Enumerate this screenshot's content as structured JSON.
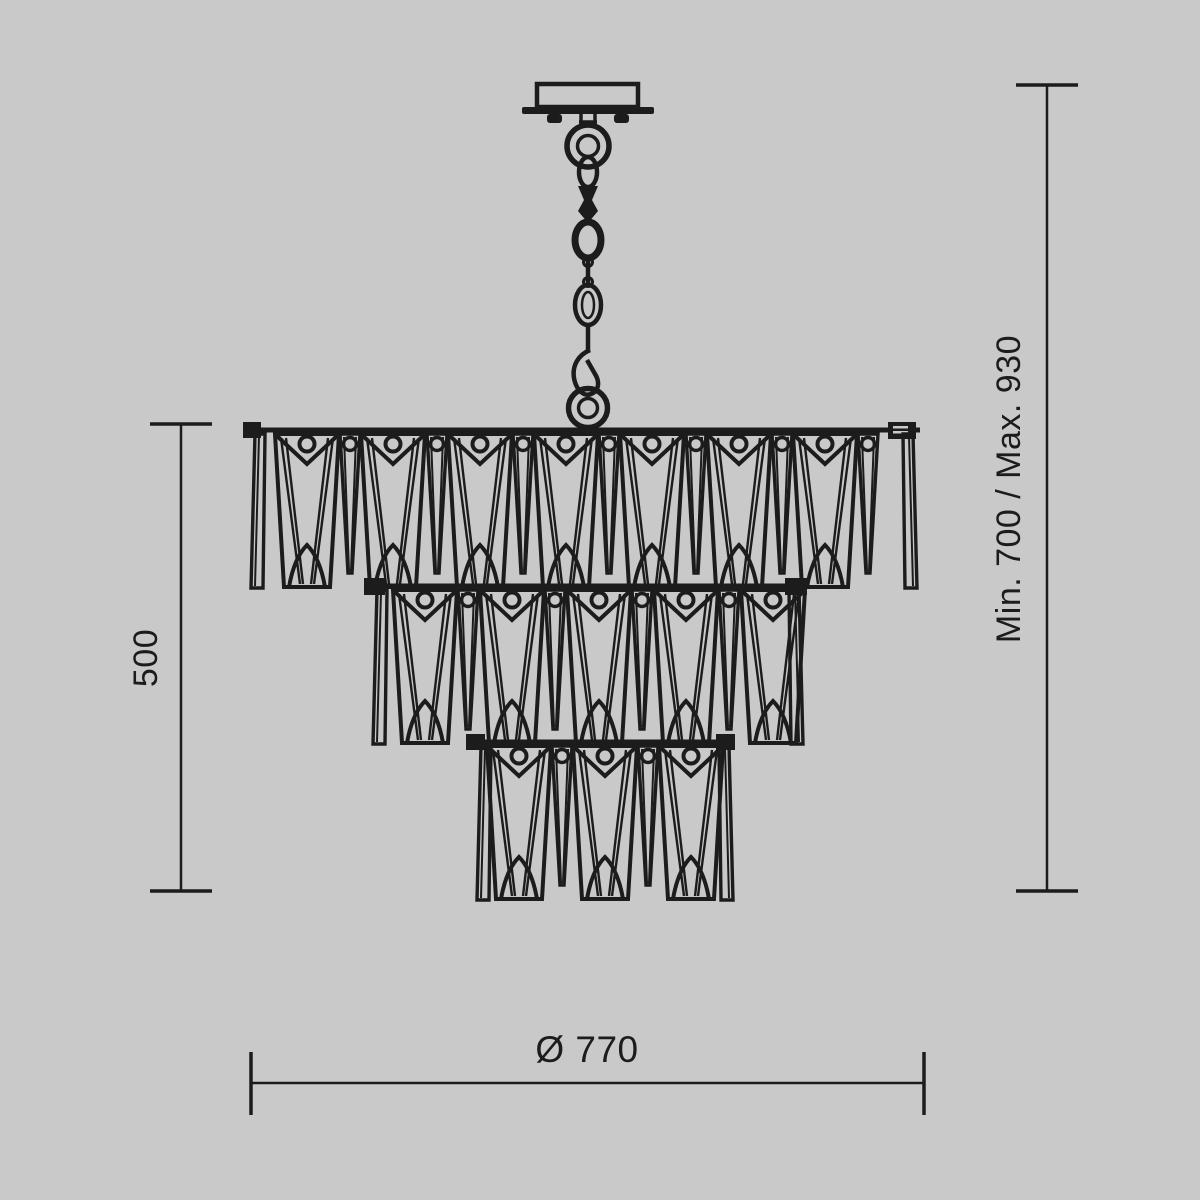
{
  "dimensions": {
    "body_height": "500",
    "suspension_range": "Min. 700 / Max. 930",
    "diameter": "Ø 770"
  },
  "colors": {
    "background": "#c9c9c9",
    "line": "#1c1c1c"
  },
  "figure": {
    "type": "technical-line-drawing",
    "subject": "three-tier crystal chandelier suspended on a chain from a ceiling canopy",
    "tiers": [
      {
        "tier": 1,
        "wide_crystals": 7,
        "narrow_crystals": 7
      },
      {
        "tier": 2,
        "wide_crystals": 5,
        "narrow_crystals": 4
      },
      {
        "tier": 3,
        "wide_crystals": 3,
        "narrow_crystals": 2
      }
    ]
  }
}
